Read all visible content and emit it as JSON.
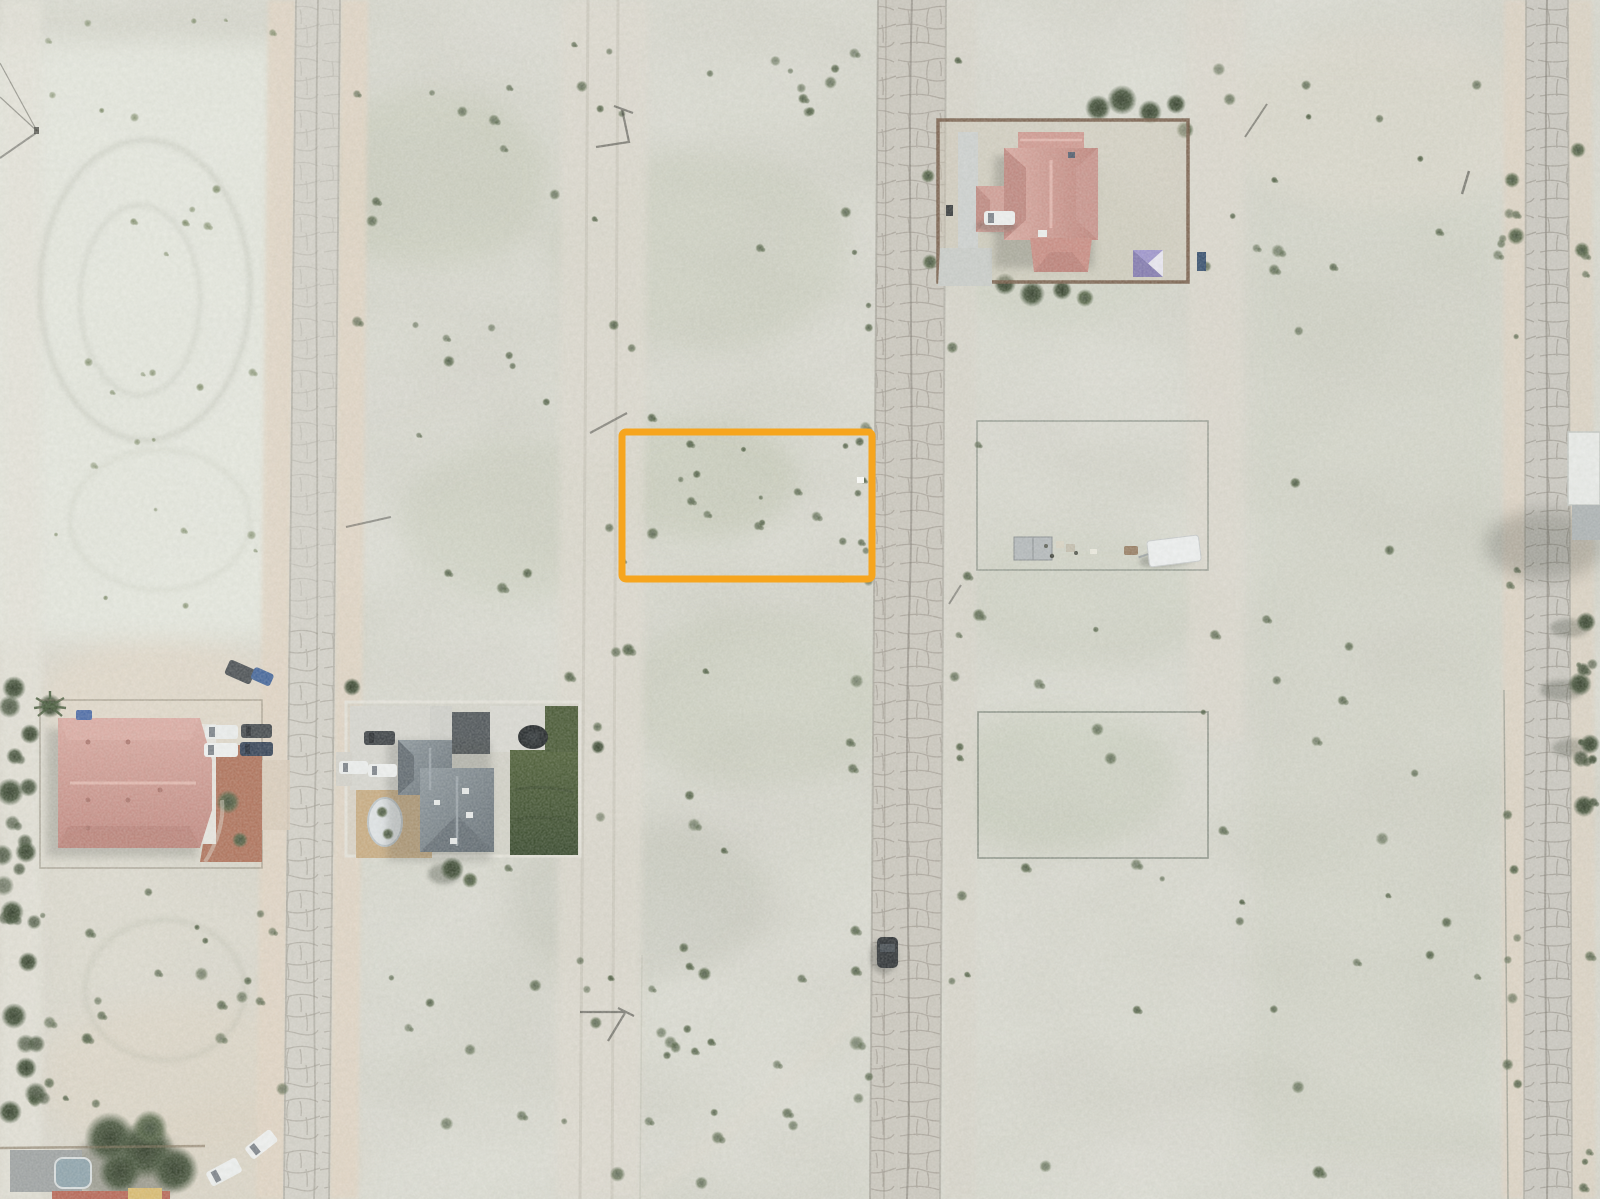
{
  "page": {
    "title": "Aerial drone photograph of desert residential parcels",
    "kind": "orthographic aerial imagery with parcel highlight"
  },
  "annotation": {
    "name": "highlighted parcel boundary",
    "color": "#F6A51E",
    "x": 622,
    "y": 432,
    "width": 250,
    "height": 147,
    "stroke_width": 7,
    "corner_radius": 4
  },
  "scene": {
    "setting": "flat desert subdivision with three cracked paved streets, vacant scrub lots, scattered homes",
    "palette": {
      "terrain": "#d1cfc7",
      "pale_patch": "#e9ebe2",
      "green_mottle": "#9dab8c",
      "road": "#c9c6bf",
      "road_crack": "#8d887e",
      "sand_shoulder": "#e2d4c3",
      "shrub": "#46543c",
      "lawn": "#3c5130",
      "pink_roof": "#cc8d85",
      "gray_roof": "#6e7880",
      "brick_patio": "#ad6d55",
      "tan_courtyard": "#c7a97e",
      "yard_fence_brown": "#6e523e",
      "wire_fence": "#6d776d",
      "trailer_white": "#eef0f1",
      "canopy": "#9a90cc"
    },
    "roads": [
      {
        "name": "left street"
      },
      {
        "name": "middle street"
      },
      {
        "name": "right street"
      }
    ],
    "buildings": [
      {
        "name": "pink-roof house in fenced yard, upper right"
      },
      {
        "name": "pink-roof house with brick driveway, mid left"
      },
      {
        "name": "gray-roof house with lawn and courtyard, center left"
      },
      {
        "name": "partial house with large tree, bottom left"
      },
      {
        "name": "white-roof building, right edge"
      }
    ],
    "vacant_lots": [
      {
        "name": "wire-fenced lot with storage container and white trailer"
      },
      {
        "name": "wire-fenced empty lot"
      }
    ],
    "vehicle_count": 14
  }
}
